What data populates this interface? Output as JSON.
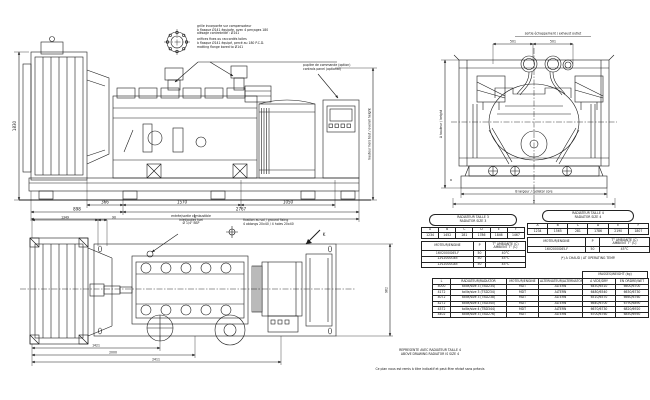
{
  "palette": {
    "ink": "#1c1c1c",
    "bg": "#ffffff"
  },
  "notes_top": {
    "fr1": "grille incorporée sur compensateur",
    "fr2": "à flasque Ø141 équipée, avec 4 perçages 180",
    "fr3": "alésage contrebridé : Ø141",
    "en1": "orifices fixes ou raccordés toiles",
    "en2": "à flasque Ø141 équipé, percé au 180 P.C.D.",
    "en3": "matting flange bored to Ø141"
  },
  "control_panel_note": {
    "fr": "pupitre de commande (option)",
    "en": "controls panel (optional)"
  },
  "fuel_note": {
    "fr": "entrée/sortie combustible",
    "en": "inlet/outlet fuel",
    "size": "Ø 1/4\" BSP"
  },
  "fixing_note": {
    "line1": "fixation au sol / ground fixing",
    "line2": "4 oblongs 20x40 / 4 holes 20x40"
  },
  "side_view": {
    "dims": {
      "a": "366",
      "b": "1570",
      "c": "1050",
      "d": "898",
      "e": "2767",
      "overall": "L",
      "height": "1830",
      "right_label": "hauteur hors tout / overall height"
    }
  },
  "end_view": {
    "top_label": "sortie échappement / exhaust outlet",
    "dim1": "501",
    "dim2": "501",
    "left_label": "A hauteur / height",
    "dim_a": "a",
    "core_label": "B largeur / radiator core",
    "overall": "D"
  },
  "plan_view": {
    "dims": {
      "a": "1349",
      "b": "90",
      "c": "1421",
      "d": "2000",
      "e": "2411",
      "side": "962"
    },
    "section_mark": "K"
  },
  "size3_table": {
    "title_fr": "RADIATEUR TAILLE 3",
    "title_en": "RADIATOR SIZE 3",
    "cols": [
      "A",
      "B",
      "C",
      "D",
      "E",
      "F"
    ],
    "vals": [
      "1234",
      "1452",
      "281",
      "1786",
      "1846",
      "1467"
    ],
    "engine_col": "MOTEUR/ENGINE",
    "p_col": "P",
    "temp_fr": "T° AMBIANTE (C)",
    "temp_en": "AMBIENT T° (C)",
    "rows": [
      [
        "16V2000G65-F",
        "50",
        "40°C"
      ],
      [
        "12V2000G65",
        "50",
        "45°C"
      ],
      [
        "12V2000G85",
        "50",
        "45°C"
      ]
    ]
  },
  "size4_table": {
    "title_fr": "RADIATEUR TAILLE 4",
    "title_en": "RADIATOR SIZE 4",
    "cols": [
      "A",
      "B",
      "C",
      "D",
      "E",
      "F"
    ],
    "vals": [
      "1234",
      "1565",
      "281",
      "1786",
      "2190",
      "1807"
    ],
    "engine_col": "MOTEUR/ENGINE",
    "p_col": "P",
    "temp_fr": "T° AMBIANTE (C)",
    "temp_en": "AMBIENT T° (C)",
    "rows": [
      [
        "16V2000G65-F",
        "50",
        "45°C"
      ]
    ],
    "footnote": "(*) A CHAUD / AT OPERATING TEMP."
  },
  "weight_table": {
    "span_header": "MASSES/WEIGHT (kg)",
    "headers": [
      "L",
      "RADIATEUR/RADIATOR",
      "MOTEUR/ENGINE",
      "ALTERNATEUR/ALTERNATOR",
      "A VIDE/DRY",
      "EN ORDRE/WET"
    ],
    "rows": [
      [
        "4000",
        "taille/size 3 (TBD234)",
        "MDT",
        "ALTERN",
        "6450/6510",
        "6600/6700"
      ],
      [
        "4172",
        "taille/size 3 (TSD234)",
        "MDT",
        "ALTERN",
        "6480/6540",
        "6630/6730"
      ],
      [
        "4072",
        "taille/size 3 (TBD238)",
        "MDT",
        "ALTERN",
        "6510/6570",
        "6660/6760"
      ],
      [
        "4272",
        "taille/size 4 (TBD340)",
        "MDT",
        "ALTERN",
        "6640/6700",
        "6790/6890"
      ],
      [
        "4372",
        "taille/size 4 (TBD344)",
        "MDT",
        "ALTERN",
        "6670/6730",
        "6820/6920"
      ],
      [
        "4402",
        "taille/size 3 (TBD276)",
        "MDT",
        "ALTERN",
        "6700/6760",
        "6850/6950"
      ]
    ]
  },
  "footer": {
    "note_fr": "REPRESENTE AVEC RADIATEUR TAILLE 4",
    "note_en": "ABOVE DRAWING RADIATOR IS SIZE 4",
    "disclaimer": "Ce plan nous est remis à titre indicatif et peut être révisé sans préavis"
  }
}
